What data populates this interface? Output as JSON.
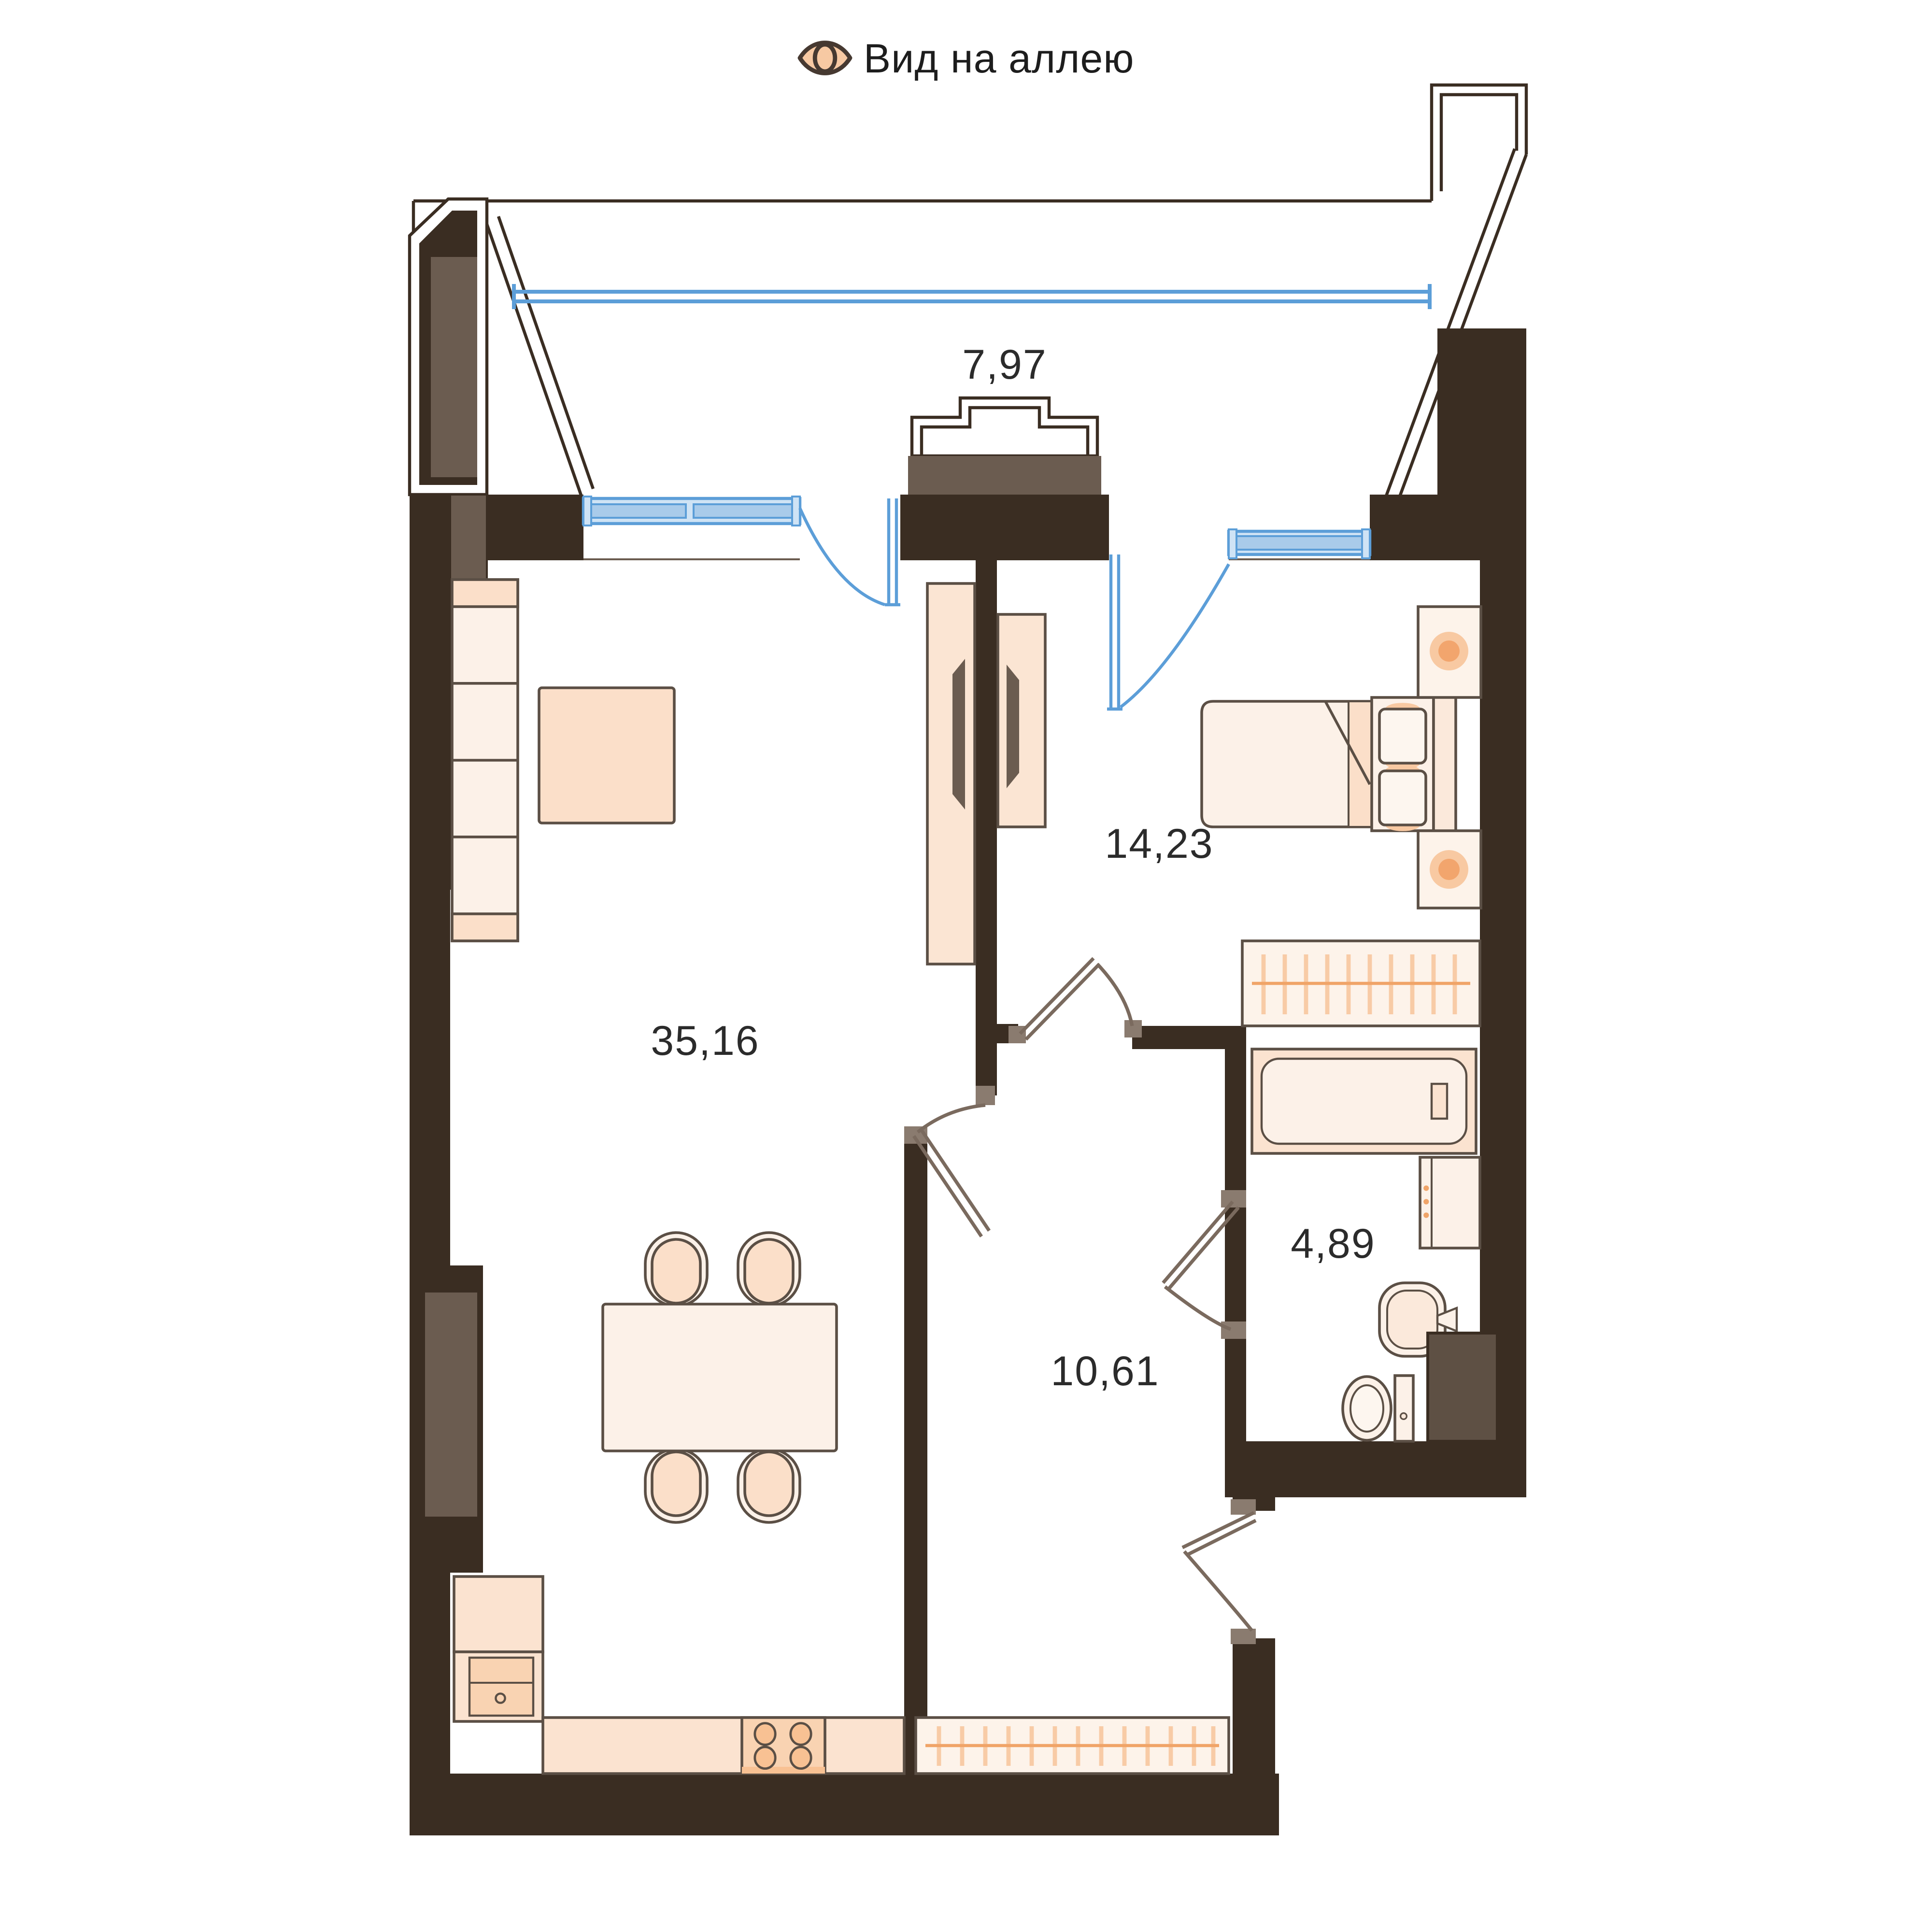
{
  "title": {
    "label": "Вид на аллею",
    "icon": "eye-icon"
  },
  "rooms": {
    "balcony": {
      "area": "7,97"
    },
    "bedroom": {
      "area": "14,23"
    },
    "living_kitchen": {
      "area": "35,16"
    },
    "bathroom": {
      "area": "4,89"
    },
    "hallway": {
      "area": "10,61"
    }
  },
  "furniture_icons": [
    "sofa",
    "coffee-table",
    "tv-unit-living",
    "tv-unit-bedroom",
    "double-bed",
    "nightstand-lamp",
    "wardrobe-rail-bedroom",
    "bathtub",
    "washing-machine",
    "sink",
    "toilet",
    "vent-duct",
    "dining-table",
    "chair",
    "fridge-column",
    "kitchen-counter",
    "stove-4-burners",
    "wardrobe-rail-hall"
  ],
  "colors": {
    "wall": "#3a2d22",
    "wall_inset_gray": "#6b5c50",
    "furniture_outline": "#5b4f45",
    "furniture_light": "#fcf1e8",
    "furniture_peach": "#fbdfc9",
    "accent_orange": "#f2a56d",
    "glazing_blue": "#5c9ed8",
    "window_fill": "#cfe3f5",
    "text": "#2b2b2b",
    "background": "#ffffff"
  }
}
